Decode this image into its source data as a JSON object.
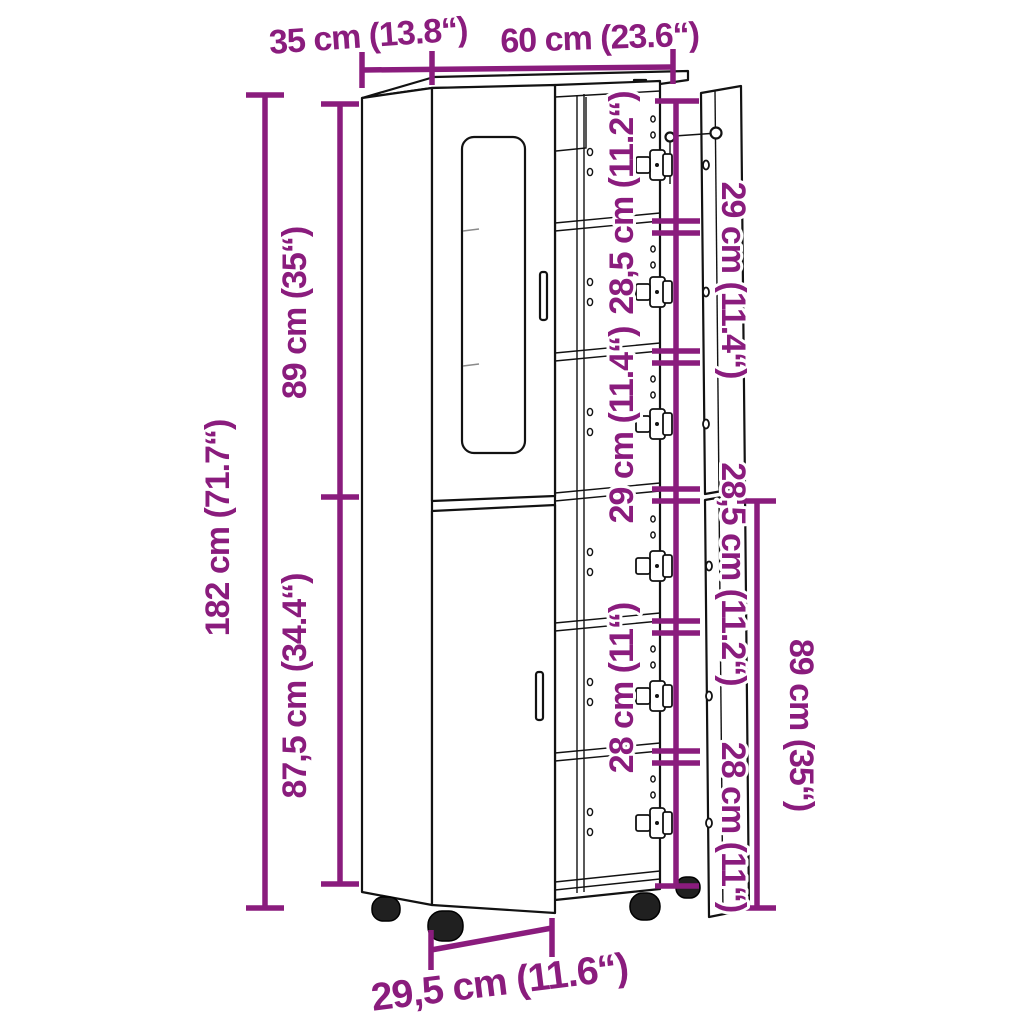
{
  "diagram": {
    "accent_color": "#8A1C7D",
    "line_color": "#121212",
    "dimensions": {
      "depth": "35 cm (13.8“)",
      "width": "60 cm (23.6“)",
      "height": "182 cm (71.7“)",
      "upper_section_height": "89 cm (35“)",
      "lower_section_height": "87,5 cm (34.4“)",
      "shelf_gaps_left": [
        "28,5 cm (11.2“)",
        "29 cm (11.4“)",
        "28 cm (11“)"
      ],
      "shelf_gaps_right": [
        "29 cm (11.4“)",
        "28,5 cm (11.2“)",
        "28 cm (11“)"
      ],
      "right_door_height": "89 cm (35“)",
      "base_width": "29,5 cm (11.6“)"
    }
  }
}
